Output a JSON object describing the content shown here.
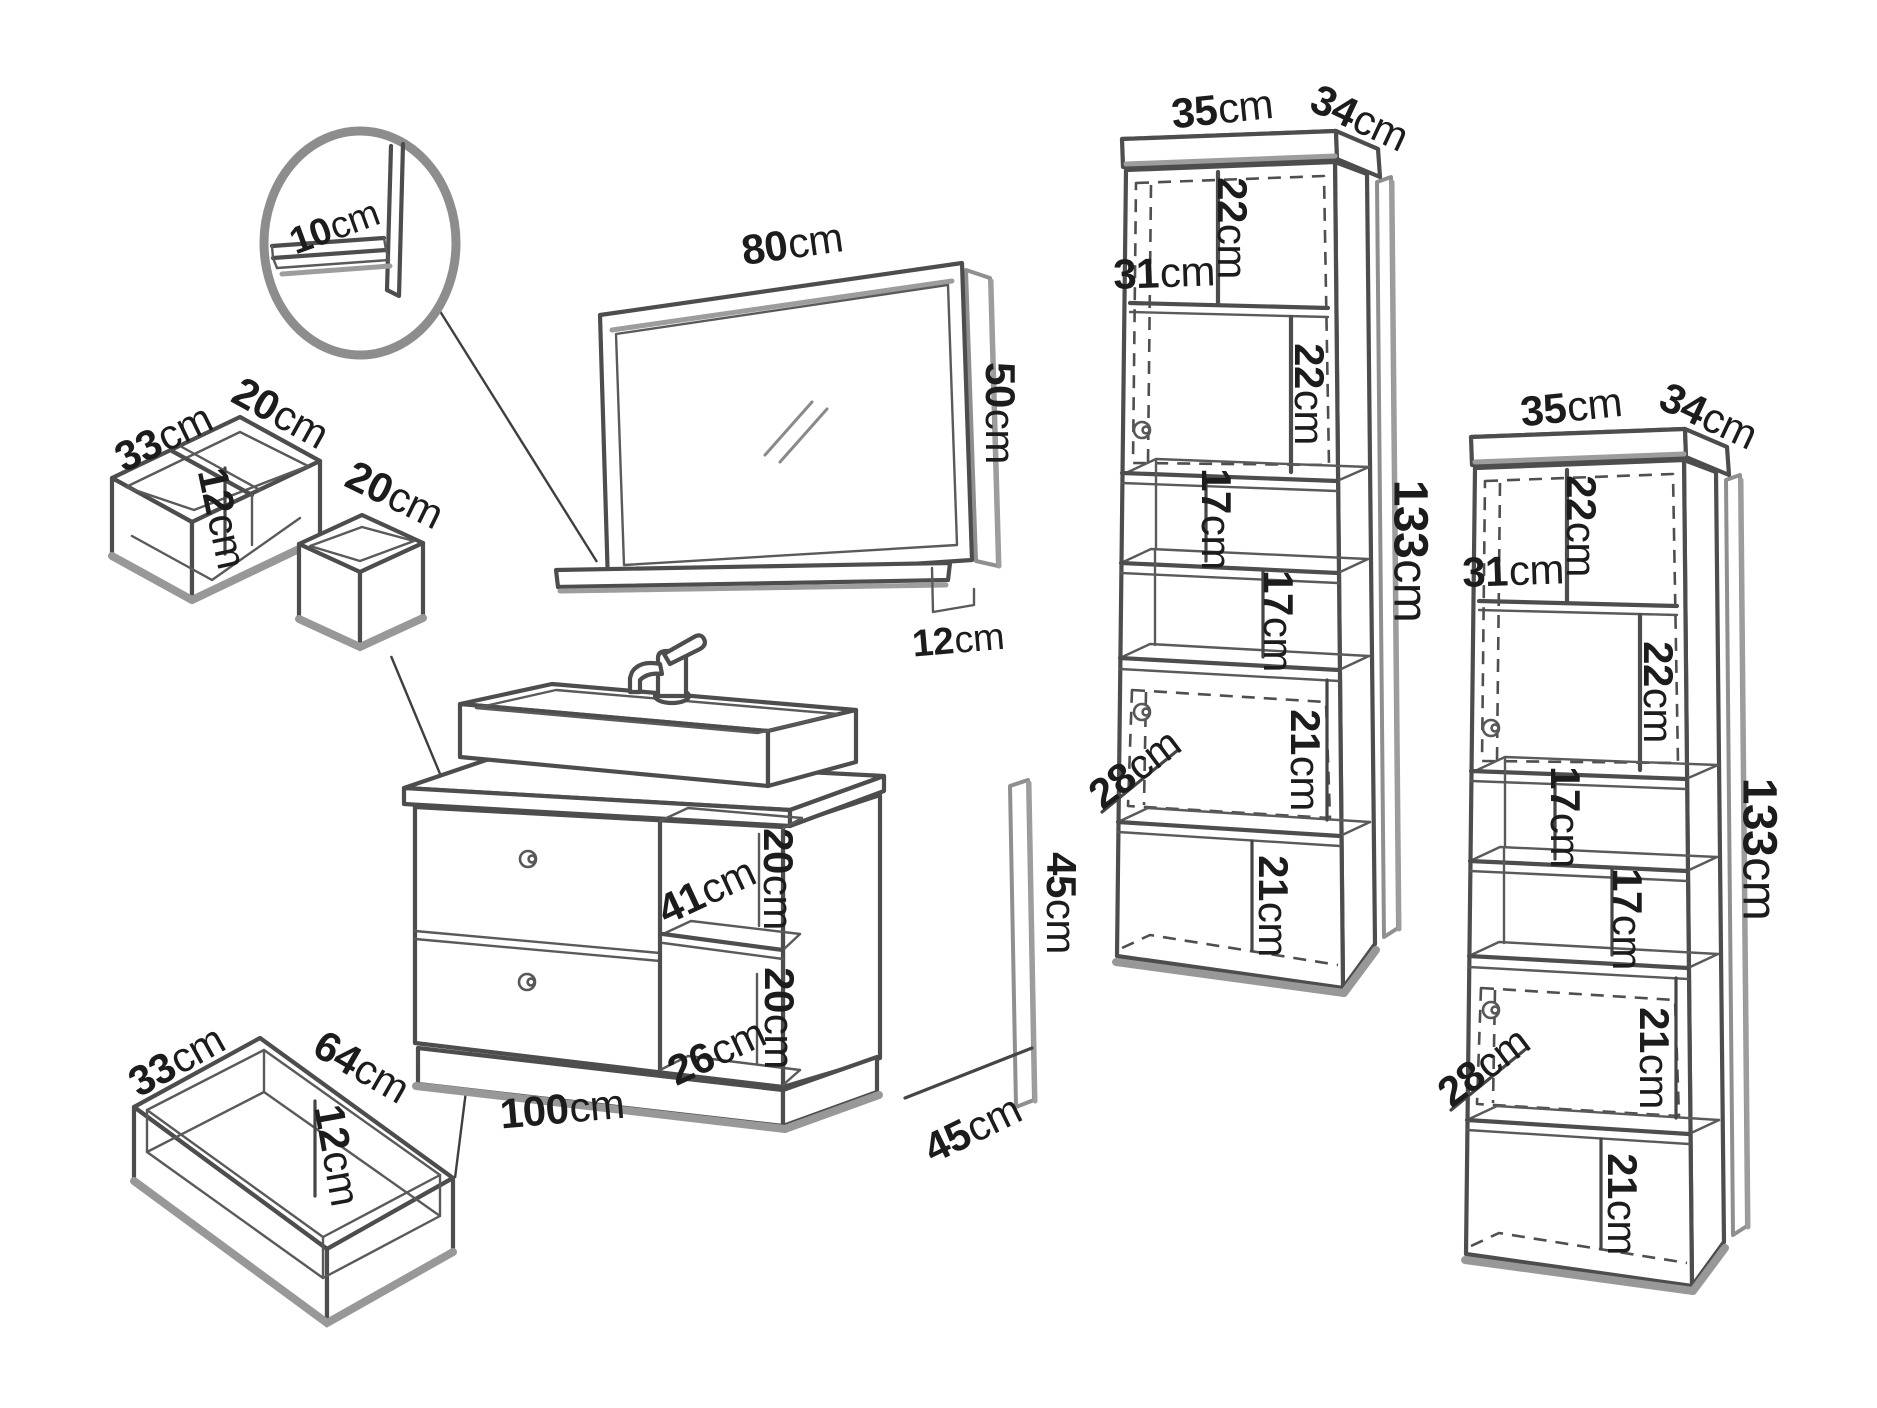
{
  "detail_circle": {
    "shelf_depth": {
      "v": "10",
      "u": "cm"
    }
  },
  "drawer_insert": {
    "width": {
      "v": "33",
      "u": "cm"
    },
    "depth_left": {
      "v": "20",
      "u": "cm"
    },
    "height": {
      "v": "12",
      "u": "cm"
    },
    "depth_right": {
      "v": "20",
      "u": "cm"
    }
  },
  "mirror": {
    "width": {
      "v": "80",
      "u": "cm"
    },
    "height": {
      "v": "50",
      "u": "cm"
    },
    "shelf_depth": {
      "v": "12",
      "u": "cm"
    }
  },
  "vanity": {
    "niche_width": {
      "v": "41",
      "u": "cm"
    },
    "niche_top_height": {
      "v": "20",
      "u": "cm"
    },
    "niche_bottom_height": {
      "v": "20",
      "u": "cm"
    },
    "niche_bottom_width": {
      "v": "26",
      "u": "cm"
    },
    "width": {
      "v": "100",
      "u": "cm"
    },
    "depth": {
      "v": "45",
      "u": "cm"
    },
    "height": {
      "v": "45",
      "u": "cm"
    }
  },
  "tall_cabinet_1": {
    "width": {
      "v": "35",
      "u": "cm"
    },
    "depth": {
      "v": "34",
      "u": "cm"
    },
    "top_compartment": {
      "v": "22",
      "u": "cm"
    },
    "shelf_width": {
      "v": "31",
      "u": "cm"
    },
    "middle_compartment": {
      "v": "22",
      "u": "cm"
    },
    "open_shelf_1": {
      "v": "17",
      "u": "cm"
    },
    "open_shelf_2": {
      "v": "17",
      "u": "cm"
    },
    "door_compartment": {
      "v": "21",
      "u": "cm"
    },
    "inner_depth": {
      "v": "28",
      "u": "cm"
    },
    "bottom_compartment": {
      "v": "21",
      "u": "cm"
    },
    "height": {
      "v": "133",
      "u": "cm"
    }
  },
  "tall_cabinet_2": {
    "width": {
      "v": "35",
      "u": "cm"
    },
    "depth": {
      "v": "34",
      "u": "cm"
    },
    "top_compartment": {
      "v": "22",
      "u": "cm"
    },
    "shelf_width": {
      "v": "31",
      "u": "cm"
    },
    "middle_compartment": {
      "v": "22",
      "u": "cm"
    },
    "open_shelf_1": {
      "v": "17",
      "u": "cm"
    },
    "open_shelf_2": {
      "v": "17",
      "u": "cm"
    },
    "door_compartment": {
      "v": "21",
      "u": "cm"
    },
    "inner_depth": {
      "v": "28",
      "u": "cm"
    },
    "bottom_compartment": {
      "v": "21",
      "u": "cm"
    },
    "height": {
      "v": "133",
      "u": "cm"
    }
  },
  "bottom_drawer": {
    "width": {
      "v": "33",
      "u": "cm"
    },
    "length": {
      "v": "64",
      "u": "cm"
    },
    "height": {
      "v": "12",
      "u": "cm"
    }
  }
}
